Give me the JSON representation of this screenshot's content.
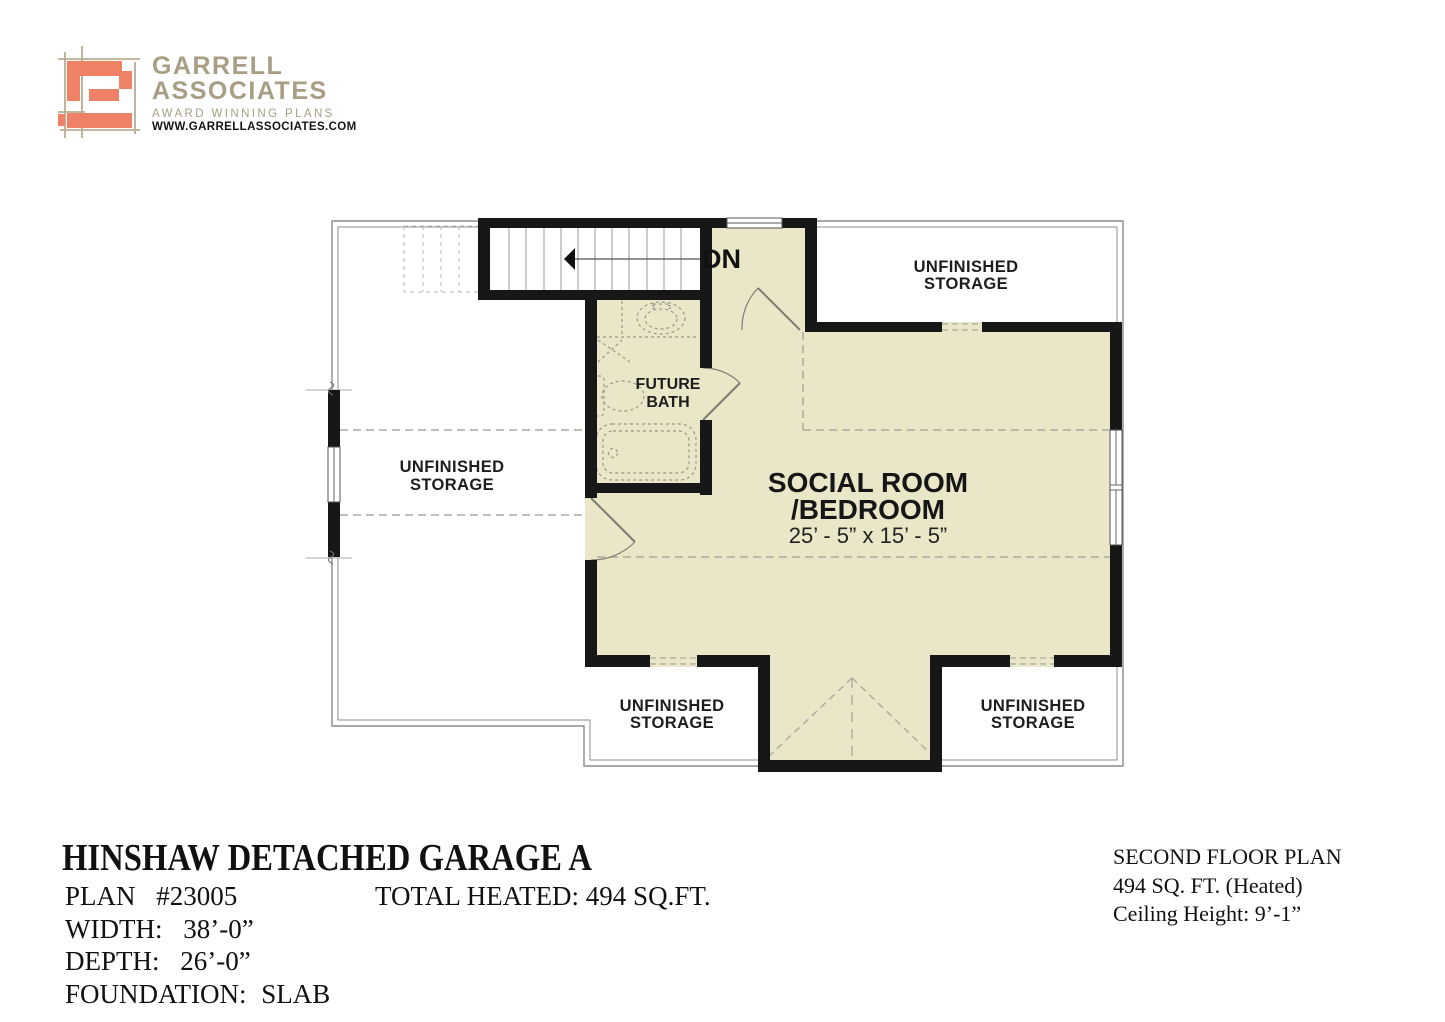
{
  "logo": {
    "brand_line1": "GARRELL",
    "brand_line2": "ASSOCIATES",
    "tagline": "AWARD WINNING PLANS",
    "website": "WWW.GARRELLASSOCIATES.COM"
  },
  "colors": {
    "heated_fill": "#EAE6C8",
    "wall": "#171717",
    "coral": "#EF8166",
    "tan_line": "#B9AE93",
    "logo_text": "#A89E83",
    "dashed_line": "#ABAB9E"
  },
  "plan": {
    "stair_label": "DN",
    "storage_label_line1": "UNFINISHED",
    "storage_label_line2": "STORAGE",
    "bath_label_line1": "FUTURE",
    "bath_label_line2": "BATH",
    "social_room_line1": "SOCIAL ROOM",
    "social_room_line2": "/BEDROOM",
    "social_room_dims": "25’ - 5” x 15’ - 5”"
  },
  "footer": {
    "title": "HINSHAW DETACHED GARAGE A",
    "plan_label": "PLAN",
    "plan_value": "#23005",
    "width_label": "WIDTH:",
    "width_value": "38’-0”",
    "depth_label": "DEPTH:",
    "depth_value": "26’-0”",
    "foundation_label": "FOUNDATION:",
    "foundation_value": "SLAB",
    "total_heated": "TOTAL HEATED: 494 SQ.FT."
  },
  "floor_info": {
    "line1": "SECOND FLOOR PLAN",
    "line2": "494 SQ. FT. (Heated)",
    "line3": "Ceiling Height: 9’-1”"
  }
}
